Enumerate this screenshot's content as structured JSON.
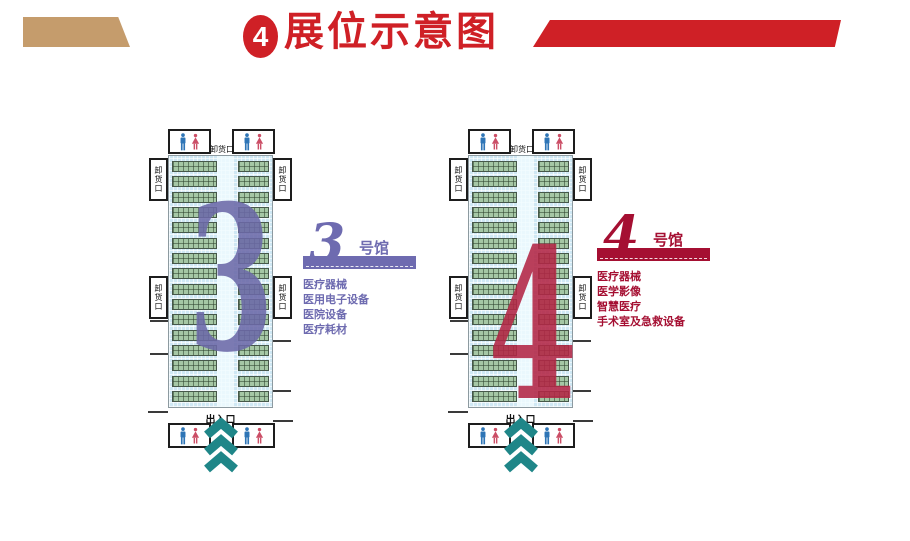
{
  "header": {
    "badge": "4",
    "title": "展位示意图"
  },
  "colors": {
    "header_red": "#cf2026",
    "tan": "#c59c6c",
    "teal": "#1f8688",
    "male_blue": "#2e75b6",
    "female_red": "#cb4e66"
  },
  "halls": [
    {
      "big_number": "3",
      "script_number": "3",
      "suffix": "号馆",
      "theme": "#6e6bb0",
      "big_color": "#6c69a8",
      "top_gate": "卸货口",
      "side_gate": "卸货口",
      "entrance": "出入口",
      "rows": 16,
      "categories": [
        "医疗器械",
        "医用电子设备",
        "医院设备",
        "医疗耗材"
      ]
    },
    {
      "big_number": "4",
      "script_number": "4",
      "suffix": "号馆",
      "theme": "#a50f32",
      "big_color": "#b32645",
      "top_gate": "卸货口",
      "side_gate": "卸货口",
      "entrance": "出入口",
      "rows": 16,
      "categories": [
        "医疗器械",
        "医学影像",
        "智慧医疗",
        "手术室及急救设备"
      ]
    }
  ]
}
